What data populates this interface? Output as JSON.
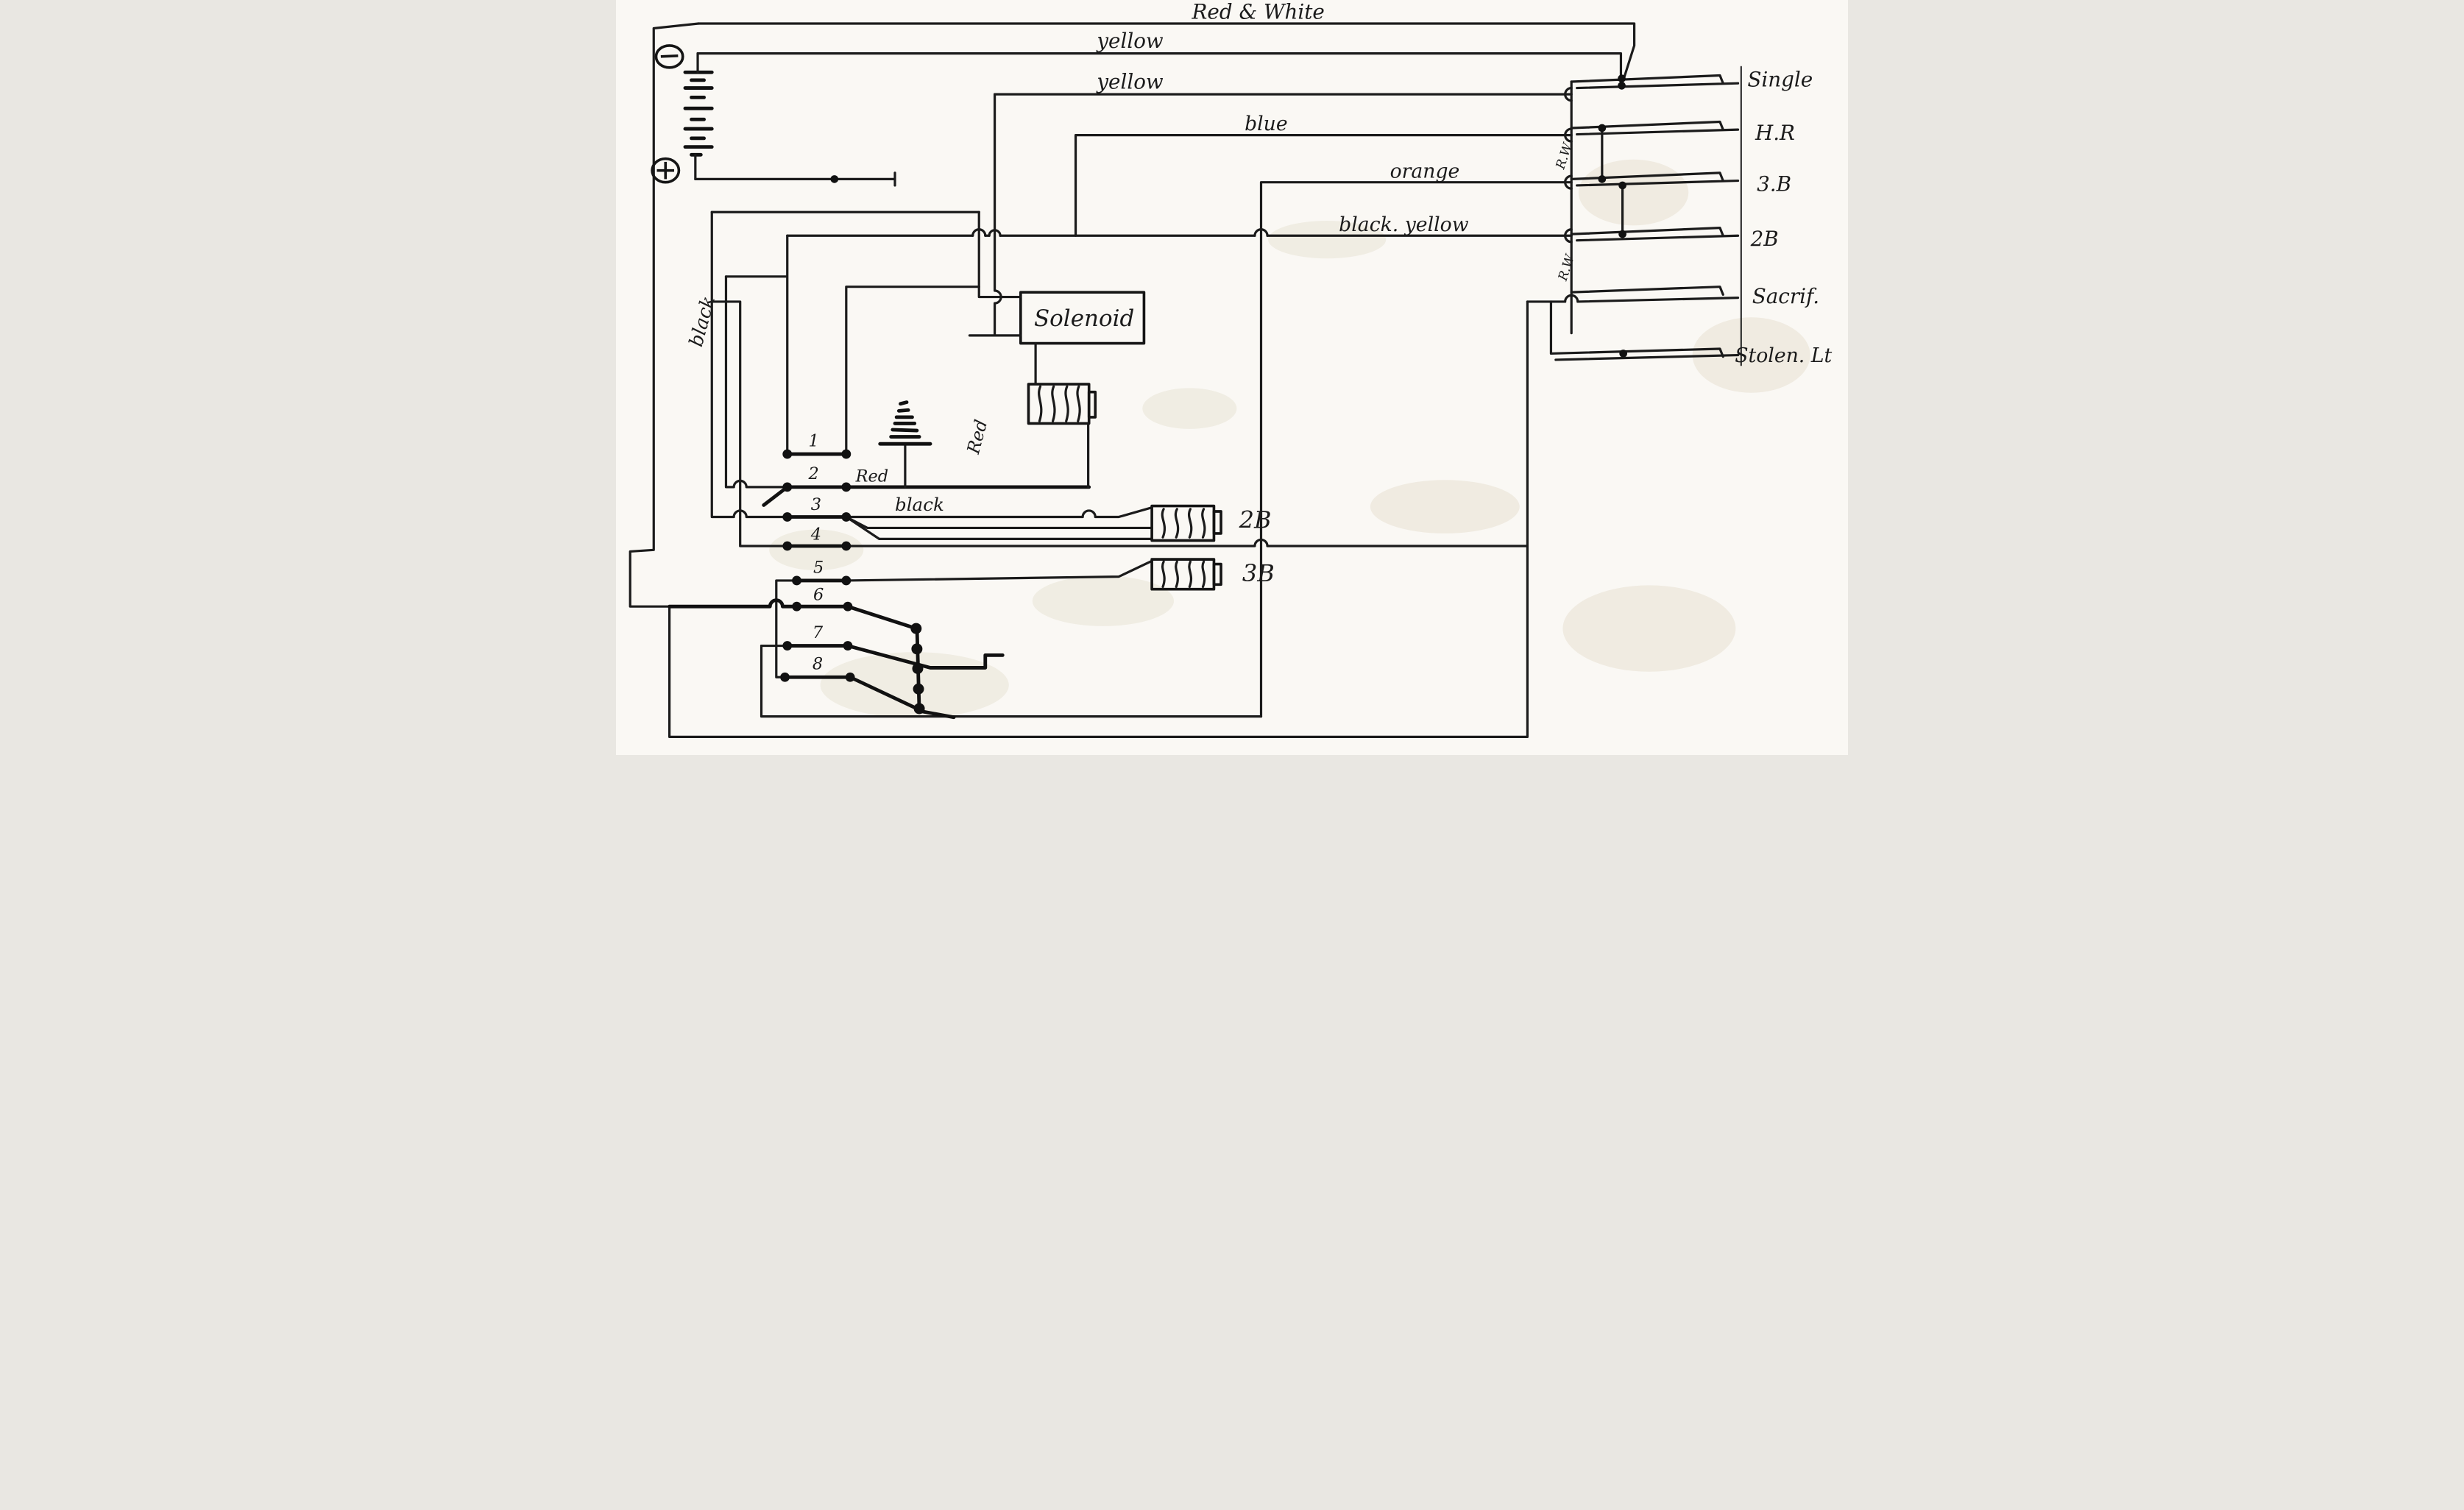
{
  "diagram": {
    "wires": {
      "red_white": "Red & White",
      "yellow_1": "yellow",
      "yellow_2": "yellow",
      "blue": "blue",
      "orange": "orange",
      "black_yellow": "black. yellow",
      "rw_1": "R.W",
      "rw_2": "R.W",
      "red_horizontal": "Red",
      "red_vertical": "Red",
      "black_horizontal": "black",
      "black_vertical": "black"
    },
    "battery": {
      "minus": "−",
      "plus": "+"
    },
    "components": {
      "solenoid": "Solenoid",
      "coil_2b": "2B",
      "coil_3b": "3B"
    },
    "switch_terminals": [
      "1",
      "2",
      "3",
      "4",
      "5",
      "6",
      "7",
      "8"
    ],
    "circuits": [
      "Single",
      "H.R",
      "3.B",
      "2B",
      "Sacrif.",
      "Stolen. Lt"
    ]
  }
}
